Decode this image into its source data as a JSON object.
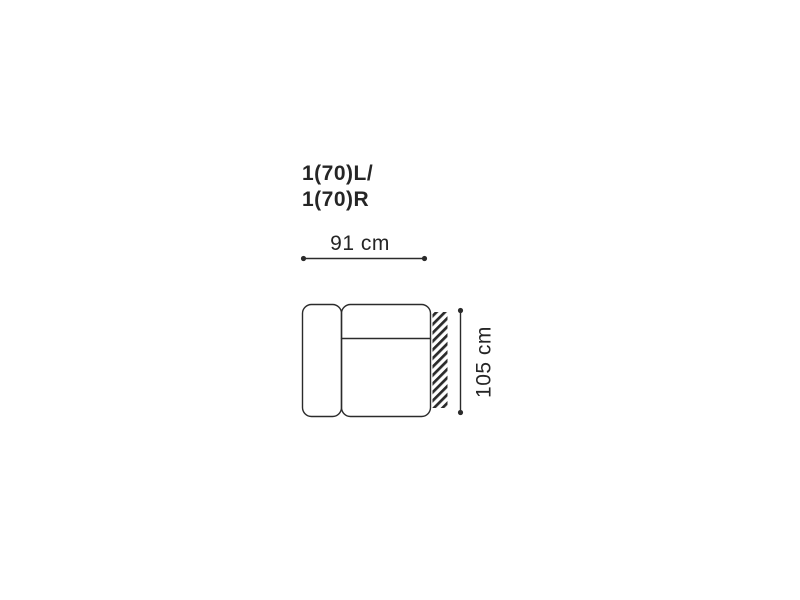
{
  "page": {
    "background": "#ffffff"
  },
  "diagram": {
    "title_line1": "1(70)L/",
    "title_line2": "1(70)R",
    "width_label": "91 cm",
    "height_label": "105 cm",
    "line_color": "#2b2b2b",
    "text_color": "#252525"
  }
}
